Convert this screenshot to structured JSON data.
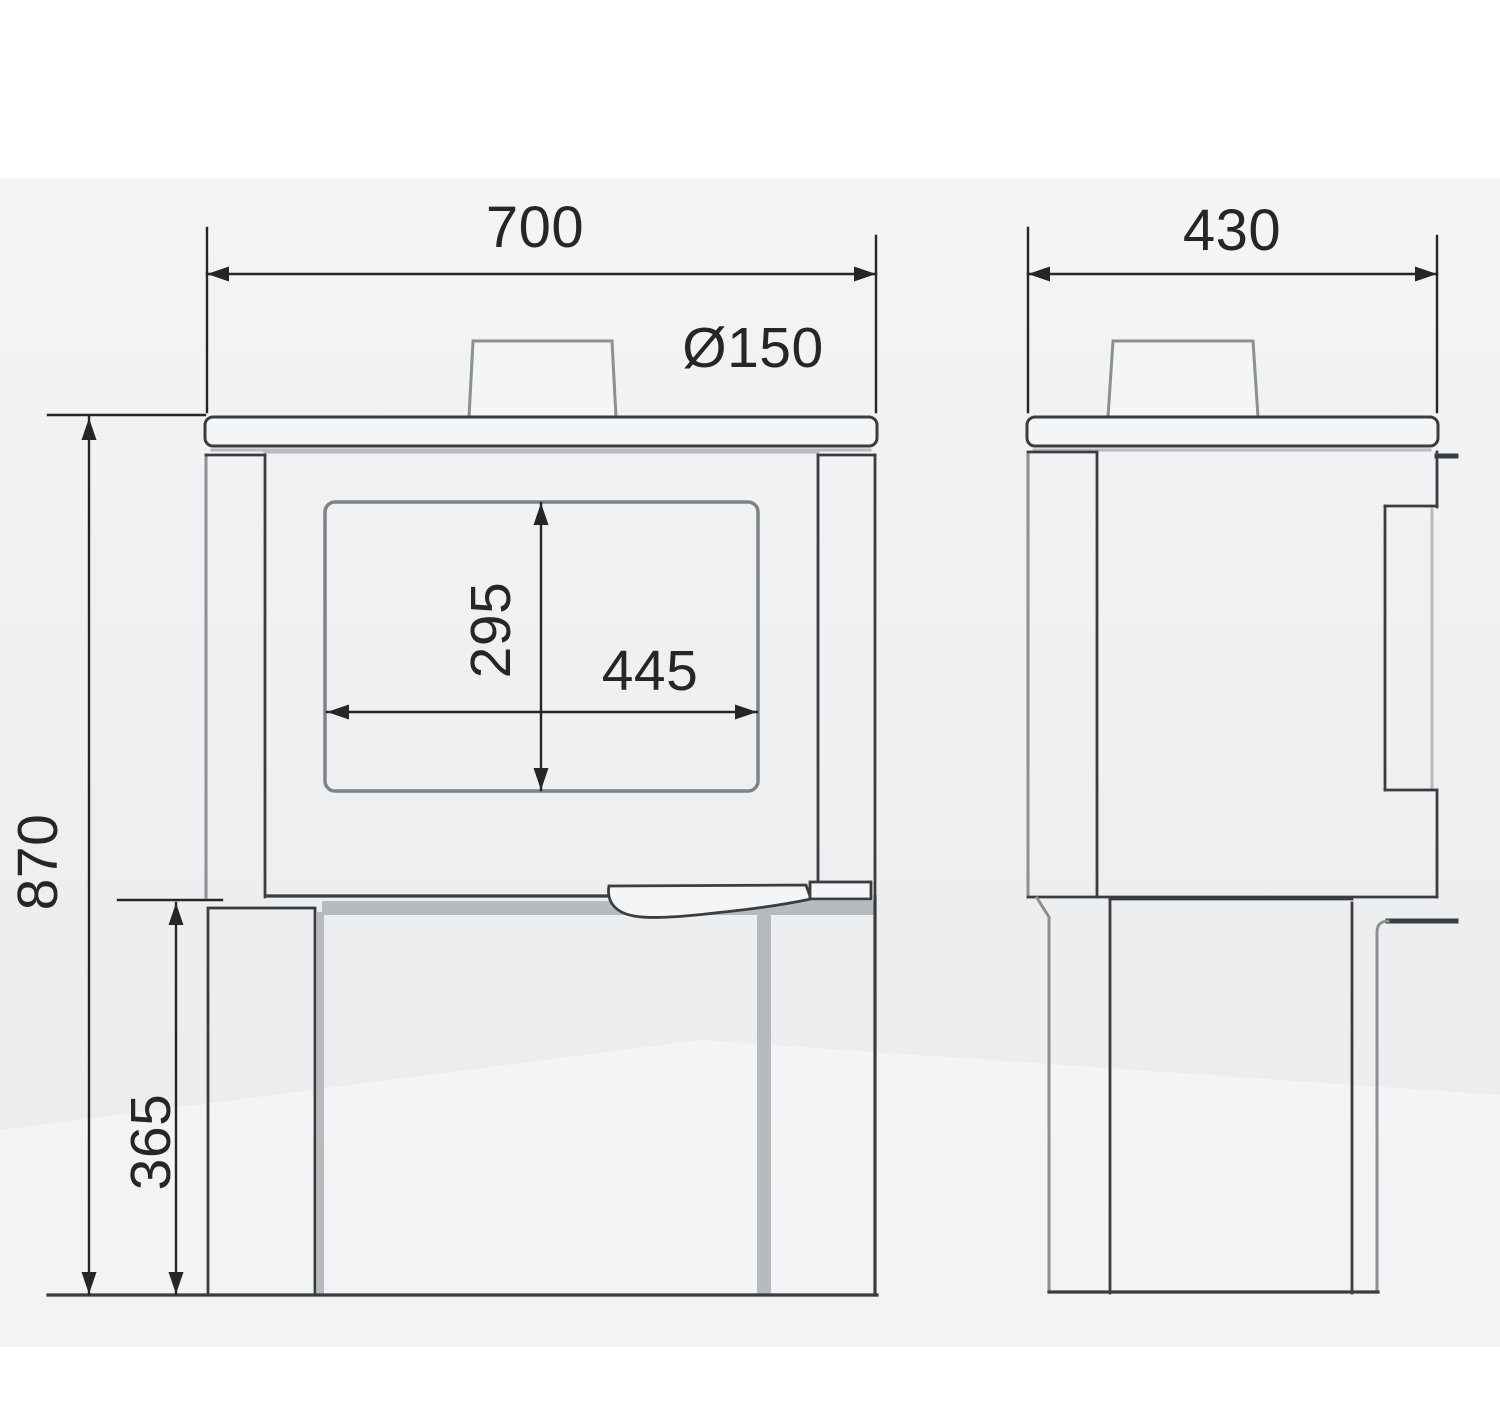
{
  "dims": {
    "front_width": "700",
    "flue_diameter": "Ø150",
    "side_depth": "430",
    "glass_height": "295",
    "glass_width": "445",
    "overall_height": "870",
    "base_height": "365"
  },
  "colors": {
    "ink": "#242628",
    "ink2": "#3a3d40",
    "mid": "#8b9093",
    "light": "#b7bbbe",
    "glass": "#7d8387",
    "panel": "#f4f5f6",
    "canvas1": "#f3f4f6",
    "canvas2": "#e9ebed",
    "floor": "#f6f7f8"
  }
}
